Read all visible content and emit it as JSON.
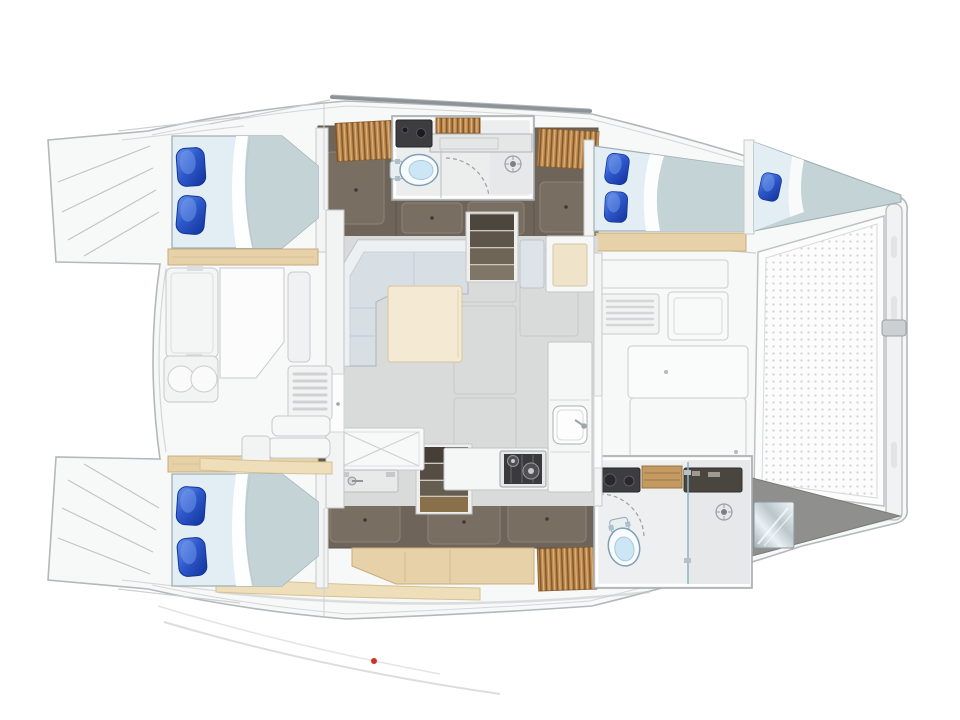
{
  "diagram": {
    "type": "yacht-floor-plan",
    "vessel": "catamaran",
    "view": "top-down deck and accommodation plan, bow to the right"
  },
  "palette": {
    "background": "#ffffff",
    "deck": "#f7f8f8",
    "outline": "#b4b8ba",
    "salon_floor": "#d9dada",
    "hull_floor": "#6e6459",
    "hull_panel": "#786e61",
    "wood": "#e6d1a8",
    "wood_slats": "#c08a4f",
    "wood_strip": "#eedfba",
    "mattress": "#e2edf4",
    "blanket": "#c3d3d6",
    "sheet": "#f8fbfc",
    "pillow_blue": "#2e59cb",
    "sofa_seat": "#d7dfe5",
    "sofa_back": "#edf0f2",
    "table_wood": "#f4e9d3",
    "counter": "#f5f6f6",
    "stove_panel": "#3a3a3c",
    "vanity_dark": "#3d3d40",
    "toilet_blue": "#cde6f6",
    "trampoline_dot": "#d2d4d5",
    "bow_locker": "#8f8f8d",
    "accent_red": "#d93025"
  },
  "regions": {
    "boat": {
      "label": "Catamaran deck plan, bow right"
    },
    "swim_platform_port": {
      "label": "Port transom swim platform with steps"
    },
    "swim_platform_starboard": {
      "label": "Starboard transom swim platform with steps"
    },
    "cockpit": {
      "label": "Aft cockpit with bench, table and stools"
    },
    "salon": {
      "label": "Salon with L-shaped sofa and table"
    },
    "galley": {
      "label": "Galley with cool box, sink and two-burner stove"
    },
    "chart_seat": {
      "label": "Chart table and seat"
    },
    "port_aft_cabin": {
      "label": "Port aft double cabin"
    },
    "starboard_aft_cabin": {
      "label": "Starboard aft double cabin"
    },
    "port_fwd_cabin": {
      "label": "Port forward double cabin"
    },
    "bow_cabin": {
      "label": "Forepeak berth"
    },
    "port_bathroom": {
      "label": "Port bathroom with toilet and shower"
    },
    "starboard_bathroom": {
      "label": "Starboard bathroom with toilet and shower"
    },
    "companionway_port": {
      "label": "Companionway steps to port hull"
    },
    "companionway_starboard": {
      "label": "Companionway steps to starboard hull"
    },
    "foredeck": {
      "label": "Foredeck lockers and forward seat"
    },
    "trampoline": {
      "label": "Bow trampoline net"
    },
    "crossbeam": {
      "label": "Forward crossbeam"
    },
    "boom": {
      "label": "Boom over coachroof"
    }
  }
}
